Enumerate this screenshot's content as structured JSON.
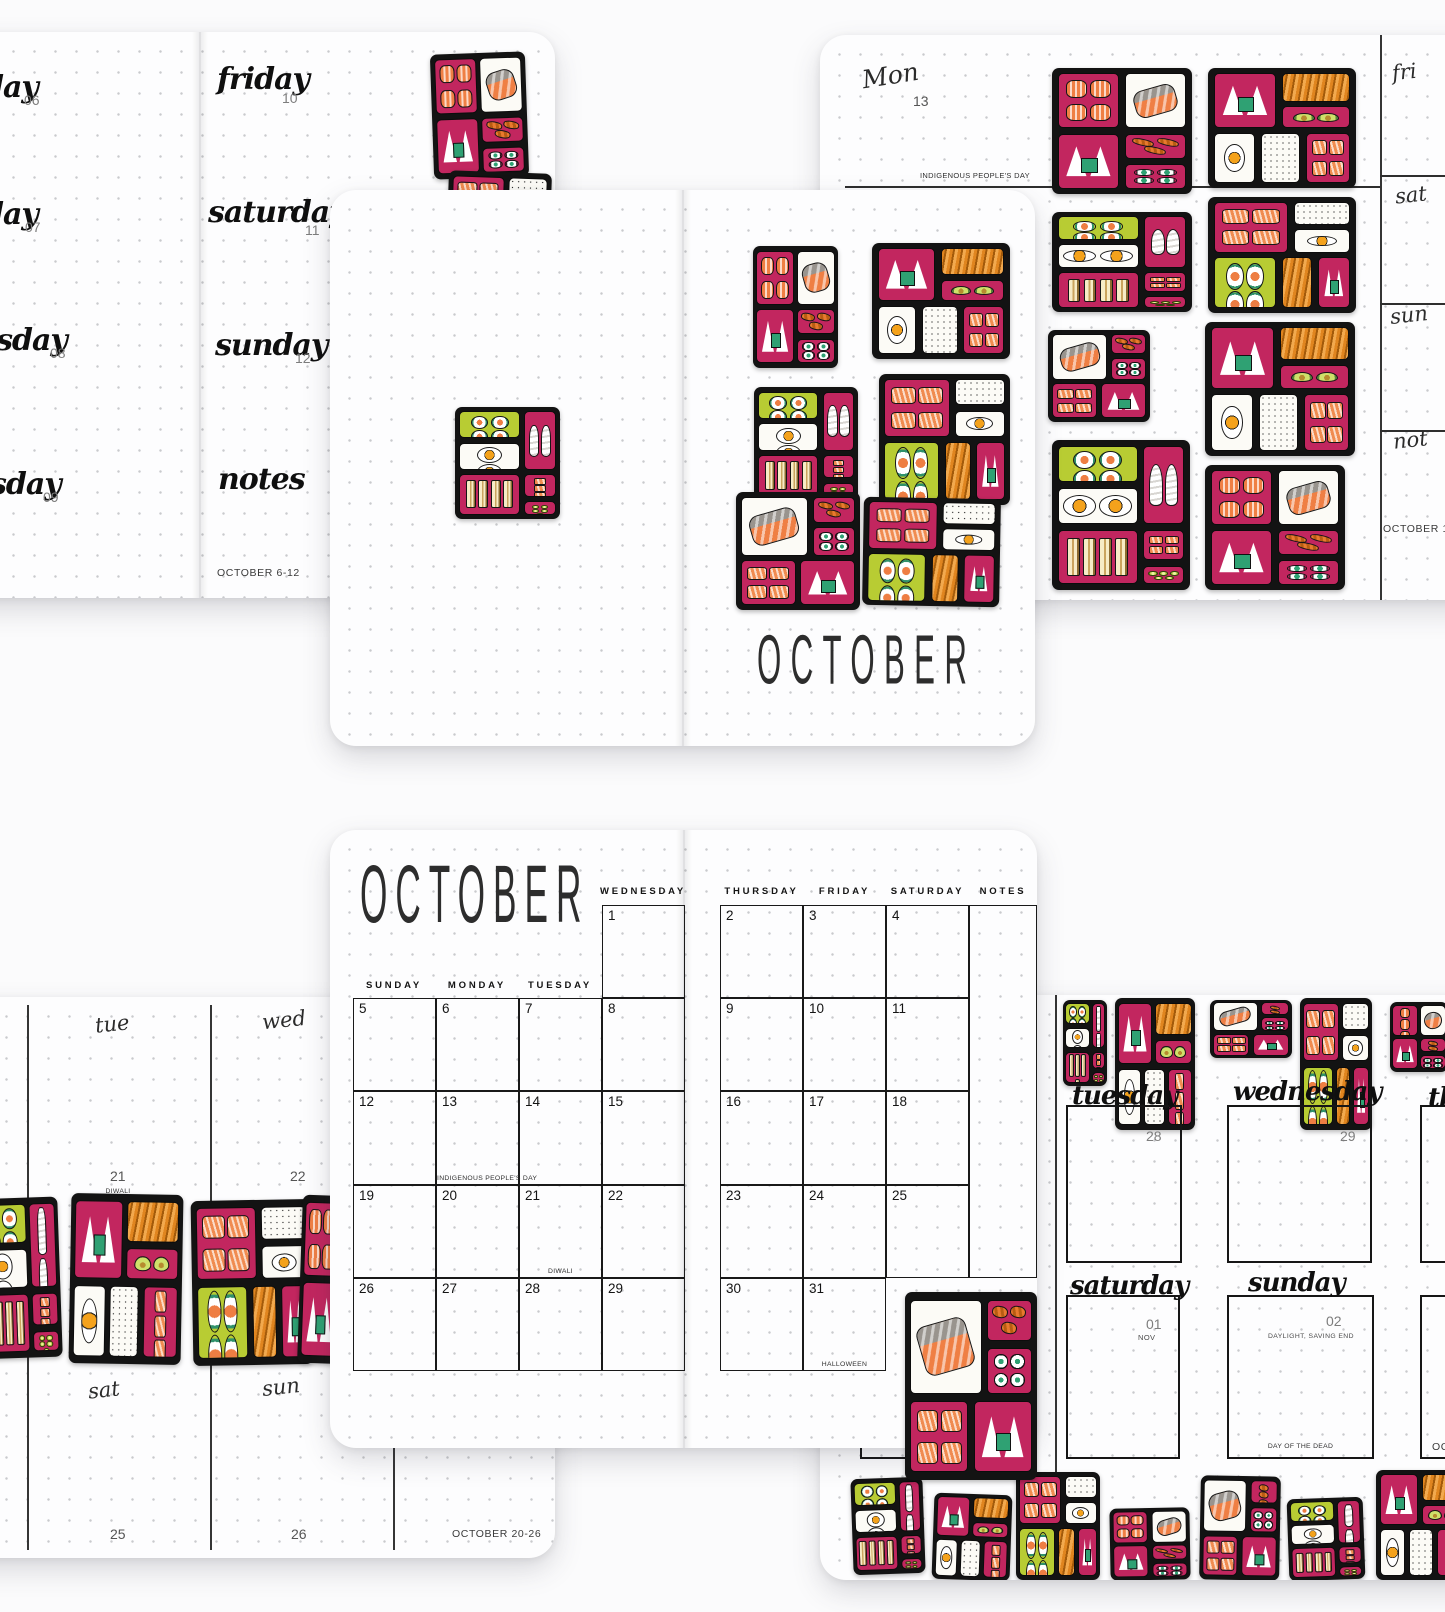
{
  "palette": {
    "magenta": "#c2265f",
    "orange": "#e87a2e",
    "salmon": "#ef7f44",
    "nori_green": "#2fa173",
    "lime": "#b8cc33",
    "yolk": "#f4a21c",
    "ink": "#131313"
  },
  "page_oct6": {
    "partial_days": [
      {
        "label": "day",
        "num": "06"
      },
      {
        "label": "day",
        "num": "07"
      },
      {
        "label": "esday",
        "num": "08"
      },
      {
        "label": "sday",
        "num": "09"
      }
    ],
    "days": [
      {
        "label": "friday",
        "num": "10"
      },
      {
        "label": "saturday",
        "num": "11"
      },
      {
        "label": "sunday",
        "num": "12"
      },
      {
        "label": "notes",
        "num": ""
      }
    ],
    "week_label": "OCTOBER 6-12"
  },
  "cover": {
    "title": "OCTOBER"
  },
  "page_oct13": {
    "day_label": "Mon",
    "day_num": "13",
    "holiday": "INDIGENOUS PEOPLE'S DAY",
    "side_days": [
      "fri",
      "sat",
      "sun",
      "not"
    ],
    "week_label": "OCTOBER 13-19"
  },
  "monthly": {
    "title": "OCTOBER",
    "left": {
      "headers": [
        "SUNDAY",
        "MONDAY",
        "TUESDAY",
        "WEDNESDAY"
      ],
      "row0": [
        {
          "col": 3,
          "num": "1"
        }
      ],
      "rows": [
        [
          "5",
          "6",
          "7",
          "8"
        ],
        [
          "12",
          "13",
          "14",
          "15"
        ],
        [
          "19",
          "20",
          "21",
          "22"
        ],
        [
          "26",
          "27",
          "28",
          "29"
        ]
      ]
    },
    "right": {
      "headers": [
        "THURSDAY",
        "FRIDAY",
        "SATURDAY",
        "NOTES"
      ],
      "rows": [
        [
          "2",
          "3",
          "4"
        ],
        [
          "9",
          "10",
          "11"
        ],
        [
          "16",
          "17",
          "18"
        ],
        [
          "23",
          "24",
          "25"
        ],
        [
          "30",
          "31"
        ]
      ]
    },
    "annotations": {
      "13": "INDIGENOUS PEOPLE'S DAY",
      "21": "DIWALI",
      "31": "HALLOWEEN"
    }
  },
  "page_oct20": {
    "top_days": [
      {
        "label": "tue",
        "num": "21",
        "note": "DIWALI"
      },
      {
        "label": "wed",
        "num": "22",
        "note": ""
      }
    ],
    "bottom_days": [
      {
        "label": "sat",
        "num": "25"
      },
      {
        "label": "sun",
        "num": "26"
      }
    ],
    "week_label": "OCTOBER 20-26"
  },
  "page_oct27": {
    "row1": [
      {
        "label": "tuesday",
        "num": "28"
      },
      {
        "label": "wednesday",
        "num": "29"
      },
      {
        "label": "th",
        "num": ""
      }
    ],
    "row2": [
      {
        "label": "",
        "num": "",
        "sub": "",
        "bottom_note": "HALLOWEEN"
      },
      {
        "label": "saturday",
        "num": "01",
        "sub": "NOV",
        "bottom_note": ""
      },
      {
        "label": "sunday",
        "num": "02",
        "sub": "DAYLIGHT, SAVING END",
        "bottom_note": "DAY OF THE DEAD"
      },
      {
        "label": "",
        "num": "",
        "sub": "",
        "bottom_note": "OCTO"
      }
    ]
  },
  "bento_patterns": {
    "P_A": [
      [
        "nigiri",
        4,
        4,
        44,
        44
      ],
      [
        "sashimi",
        52,
        4,
        44,
        44
      ],
      [
        "onigiri",
        4,
        52,
        44,
        44
      ],
      [
        "fried",
        52,
        52,
        44,
        20
      ],
      [
        "rolls_sm",
        52,
        76,
        44,
        20
      ]
    ],
    "P_B": [
      [
        "onigiri",
        4,
        4,
        42,
        46
      ],
      [
        "noodles",
        50,
        4,
        46,
        24
      ],
      [
        "avocado",
        50,
        32,
        46,
        18
      ],
      [
        "egg",
        4,
        54,
        28,
        42
      ],
      [
        "ricesp",
        36,
        54,
        26,
        42
      ],
      [
        "salmon",
        66,
        54,
        30,
        42
      ]
    ],
    "P_C": [
      [
        "rolls",
        4,
        4,
        58,
        24
      ],
      [
        "eggs2",
        4,
        32,
        58,
        24
      ],
      [
        "whitefish",
        66,
        4,
        30,
        52
      ],
      [
        "sandwich",
        4,
        60,
        58,
        36
      ],
      [
        "salmon",
        66,
        60,
        30,
        20
      ],
      [
        "cuke",
        66,
        84,
        30,
        12
      ]
    ],
    "P_D": [
      [
        "salmon",
        4,
        4,
        50,
        44
      ],
      [
        "ricesp",
        58,
        4,
        38,
        20
      ],
      [
        "egg",
        58,
        28,
        38,
        20
      ],
      [
        "rolls",
        4,
        52,
        42,
        44
      ],
      [
        "noodles",
        50,
        52,
        20,
        44
      ],
      [
        "onigiri",
        74,
        52,
        22,
        44
      ]
    ],
    "P_E": [
      [
        "sashimi",
        4,
        4,
        54,
        50
      ],
      [
        "fried",
        62,
        4,
        34,
        22
      ],
      [
        "rolls_sm",
        62,
        30,
        34,
        24
      ],
      [
        "salmon",
        4,
        58,
        44,
        38
      ],
      [
        "onigiri",
        52,
        58,
        44,
        38
      ]
    ]
  },
  "stickers": {
    "page_a": [
      [
        732,
        21,
        95,
        125,
        "P_A",
        -2
      ],
      [
        747,
        140,
        103,
        115,
        "P_D",
        2
      ]
    ],
    "cover": [
      [
        125,
        217,
        105,
        112,
        "P_C",
        0
      ],
      [
        423,
        56,
        85,
        122,
        "P_A",
        0
      ],
      [
        542,
        53,
        138,
        116,
        "P_B",
        0
      ],
      [
        424,
        197,
        104,
        114,
        "P_C",
        0
      ],
      [
        549,
        184,
        131,
        131,
        "P_D",
        0
      ],
      [
        406,
        302,
        124,
        118,
        "P_E",
        0
      ],
      [
        533,
        308,
        137,
        108,
        "P_D",
        1
      ]
    ],
    "page_c": [
      [
        232,
        33,
        140,
        126,
        "P_A",
        0
      ],
      [
        388,
        33,
        148,
        120,
        "P_B",
        0
      ],
      [
        232,
        177,
        140,
        100,
        "P_C",
        0
      ],
      [
        388,
        162,
        148,
        116,
        "P_D",
        0
      ],
      [
        228,
        295,
        102,
        92,
        "P_E",
        0
      ],
      [
        385,
        287,
        150,
        134,
        "P_B",
        0
      ],
      [
        232,
        405,
        138,
        150,
        "P_C",
        0
      ],
      [
        385,
        430,
        140,
        125,
        "P_A",
        0
      ]
    ],
    "monthly_corner": [
      [
        905,
        1292,
        132,
        188,
        "P_E",
        0
      ]
    ],
    "page_e": [
      [
        135,
        201,
        85,
        160,
        "P_C",
        -2
      ],
      [
        230,
        197,
        112,
        170,
        "P_B",
        1
      ],
      [
        352,
        203,
        120,
        165,
        "P_D",
        -1
      ],
      [
        460,
        199,
        80,
        168,
        "P_A",
        2
      ]
    ],
    "page_f_top": [
      [
        243,
        5,
        44,
        86,
        "P_C",
        0
      ],
      [
        295,
        3,
        80,
        132,
        "P_B",
        0
      ],
      [
        390,
        5,
        82,
        58,
        "P_E",
        0
      ],
      [
        480,
        3,
        72,
        132,
        "P_D",
        0
      ],
      [
        570,
        7,
        58,
        70,
        "P_A",
        0
      ]
    ],
    "page_f_bottom": [
      [
        32,
        483,
        72,
        96,
        "P_C",
        -2
      ],
      [
        113,
        499,
        78,
        86,
        "P_B",
        2
      ],
      [
        196,
        477,
        84,
        108,
        "P_D",
        0
      ],
      [
        290,
        513,
        80,
        72,
        "P_A",
        -1
      ],
      [
        380,
        481,
        80,
        104,
        "P_E",
        1
      ],
      [
        468,
        503,
        76,
        82,
        "P_C",
        -2
      ],
      [
        556,
        475,
        92,
        110,
        "P_B",
        0
      ]
    ]
  }
}
